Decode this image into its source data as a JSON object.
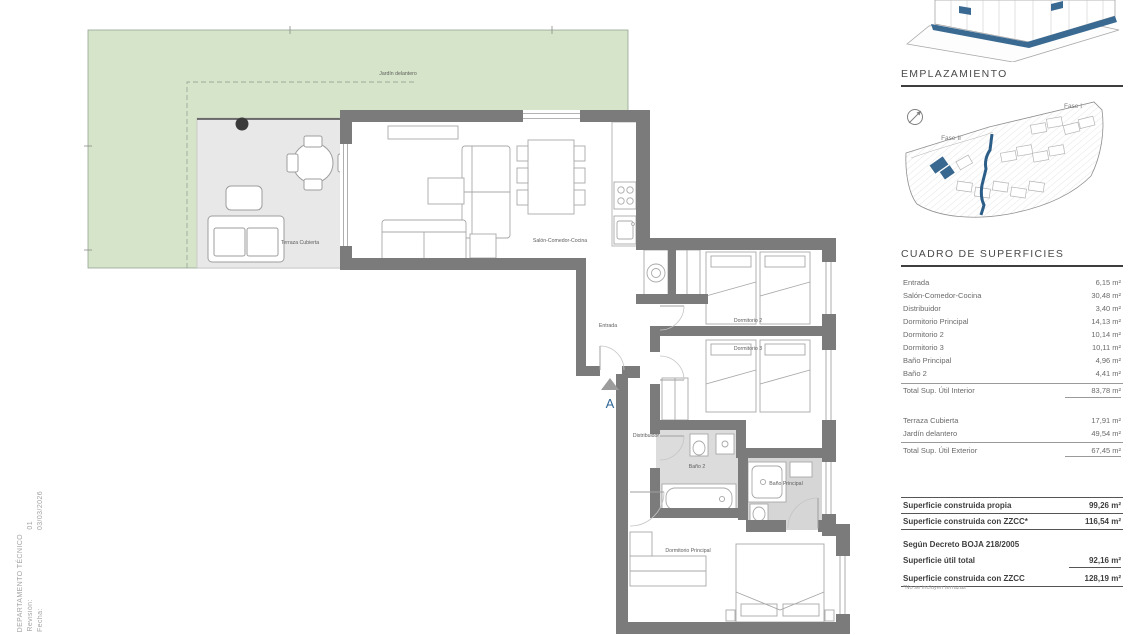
{
  "plan": {
    "labels": {
      "garden": "Jardín delantero",
      "terrace": "Terraza Cubierta",
      "living": "Salón-Comedor-Cocina",
      "entrance": "Entrada",
      "bedroom2": "Dormitorio 2",
      "bedroom3": "Dormitorio 3",
      "hall": "Distribuidor",
      "bath2": "Baño 2",
      "bath_main": "Baño Principal",
      "bedroom_main": "Dormitorio Principal",
      "section_marker": "A"
    },
    "colors": {
      "garden": "#d6e5c9",
      "wall": "#7b7b7b",
      "terrace_floor": "#e8e8e8",
      "bath_floor": "#dadada",
      "accent_blue": "#2f6695"
    }
  },
  "sidebar": {
    "emplazamiento": {
      "title": "EMPLAZAMIENTO",
      "fase1_label": "Fase I",
      "fase2_label": "Fase II"
    },
    "surfaces": {
      "title": "CUADRO DE SUPERFICIES",
      "interior": {
        "rows": [
          {
            "label": "Entrada",
            "value": "6,15 m²"
          },
          {
            "label": "Salón-Comedor-Cocina",
            "value": "30,48 m²"
          },
          {
            "label": "Distribuidor",
            "value": "3,40 m²"
          },
          {
            "label": "Dormitorio Principal",
            "value": "14,13 m²"
          },
          {
            "label": "Dormitorio 2",
            "value": "10,14 m²"
          },
          {
            "label": "Dormitorio 3",
            "value": "10,11 m²"
          },
          {
            "label": "Baño Principal",
            "value": "4,96 m²"
          },
          {
            "label": "Baño 2",
            "value": "4,41 m²"
          }
        ],
        "total": {
          "label": "Total Sup. Útil Interior",
          "value": "83,78 m²"
        }
      },
      "exterior": {
        "rows": [
          {
            "label": "Terraza Cubierta",
            "value": "17,91 m²"
          },
          {
            "label": "Jardín delantero",
            "value": "49,54 m²"
          }
        ],
        "total": {
          "label": "Total Sup. Útil Exterior",
          "value": "67,45 m²"
        }
      },
      "built": {
        "rows": [
          {
            "label": "Superficie construida propia",
            "value": "99,26 m²"
          },
          {
            "label": "Superficie construida con ZZCC*",
            "value": "116,54 m²"
          }
        ]
      },
      "decree": {
        "heading": "Según Decreto BOJA 218/2005",
        "rows": [
          {
            "label": "Superficie útil total",
            "value": "92,16 m²"
          },
          {
            "label": "Superficie construida con ZZCC",
            "value": "128,19 m²"
          }
        ]
      },
      "footnote": "*No se incluyen terrazas"
    }
  },
  "footer": {
    "department": "DEPARTAMENTO TÉCNICO",
    "revision_label": "Revisión:",
    "revision_value": "01",
    "date_label": "Fecha:",
    "date_value": "03/03/2026"
  }
}
